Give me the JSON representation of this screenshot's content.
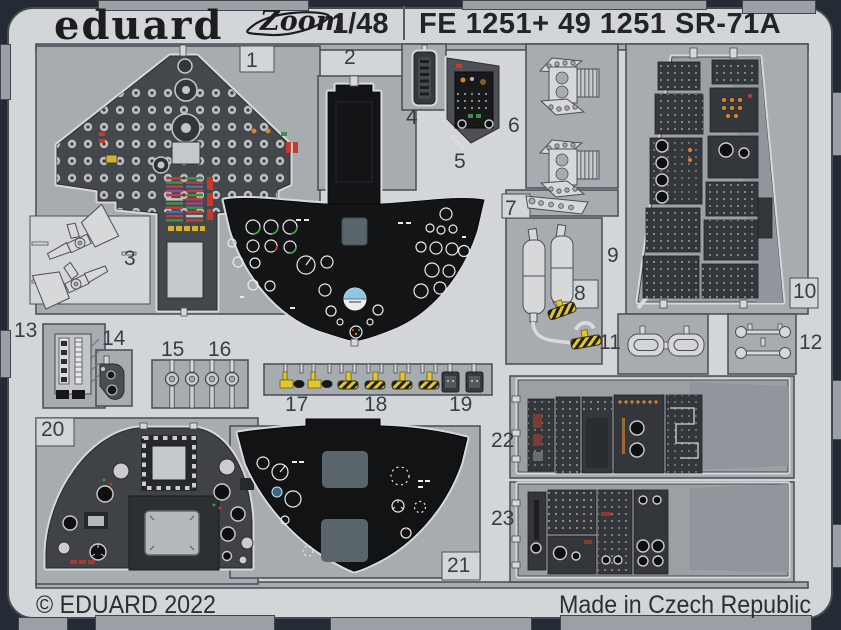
{
  "header": {
    "brand": "eduard",
    "zoom_logo": "Zoom",
    "scale": "1/48",
    "product_code": "FE 1251+ 49 1251 SR-71A"
  },
  "footer": {
    "copyright": "© EDUARD 2022",
    "made_in": "Made in Czech Republic"
  },
  "parts": [
    "1",
    "2",
    "3",
    "4",
    "5",
    "6",
    "7",
    "8",
    "9",
    "10",
    "11",
    "12",
    "13",
    "14",
    "15",
    "16",
    "17",
    "18",
    "19",
    "20",
    "21",
    "22",
    "23"
  ],
  "colors": {
    "border_navy": "#242b34",
    "card": "#d3d6d8",
    "fret_plate": "#a7acb1",
    "panel_dark_gray": "#44474b",
    "panel_black": "#121416",
    "etched_light": "#d6d8da",
    "accent_yellow": "#e2c72e",
    "accent_red": "#c23a30",
    "accent_green": "#3f8f4a",
    "accent_orange": "#d8872b",
    "screen_gray": "#5a646b",
    "attitude_blue": "#8ec6e8"
  }
}
